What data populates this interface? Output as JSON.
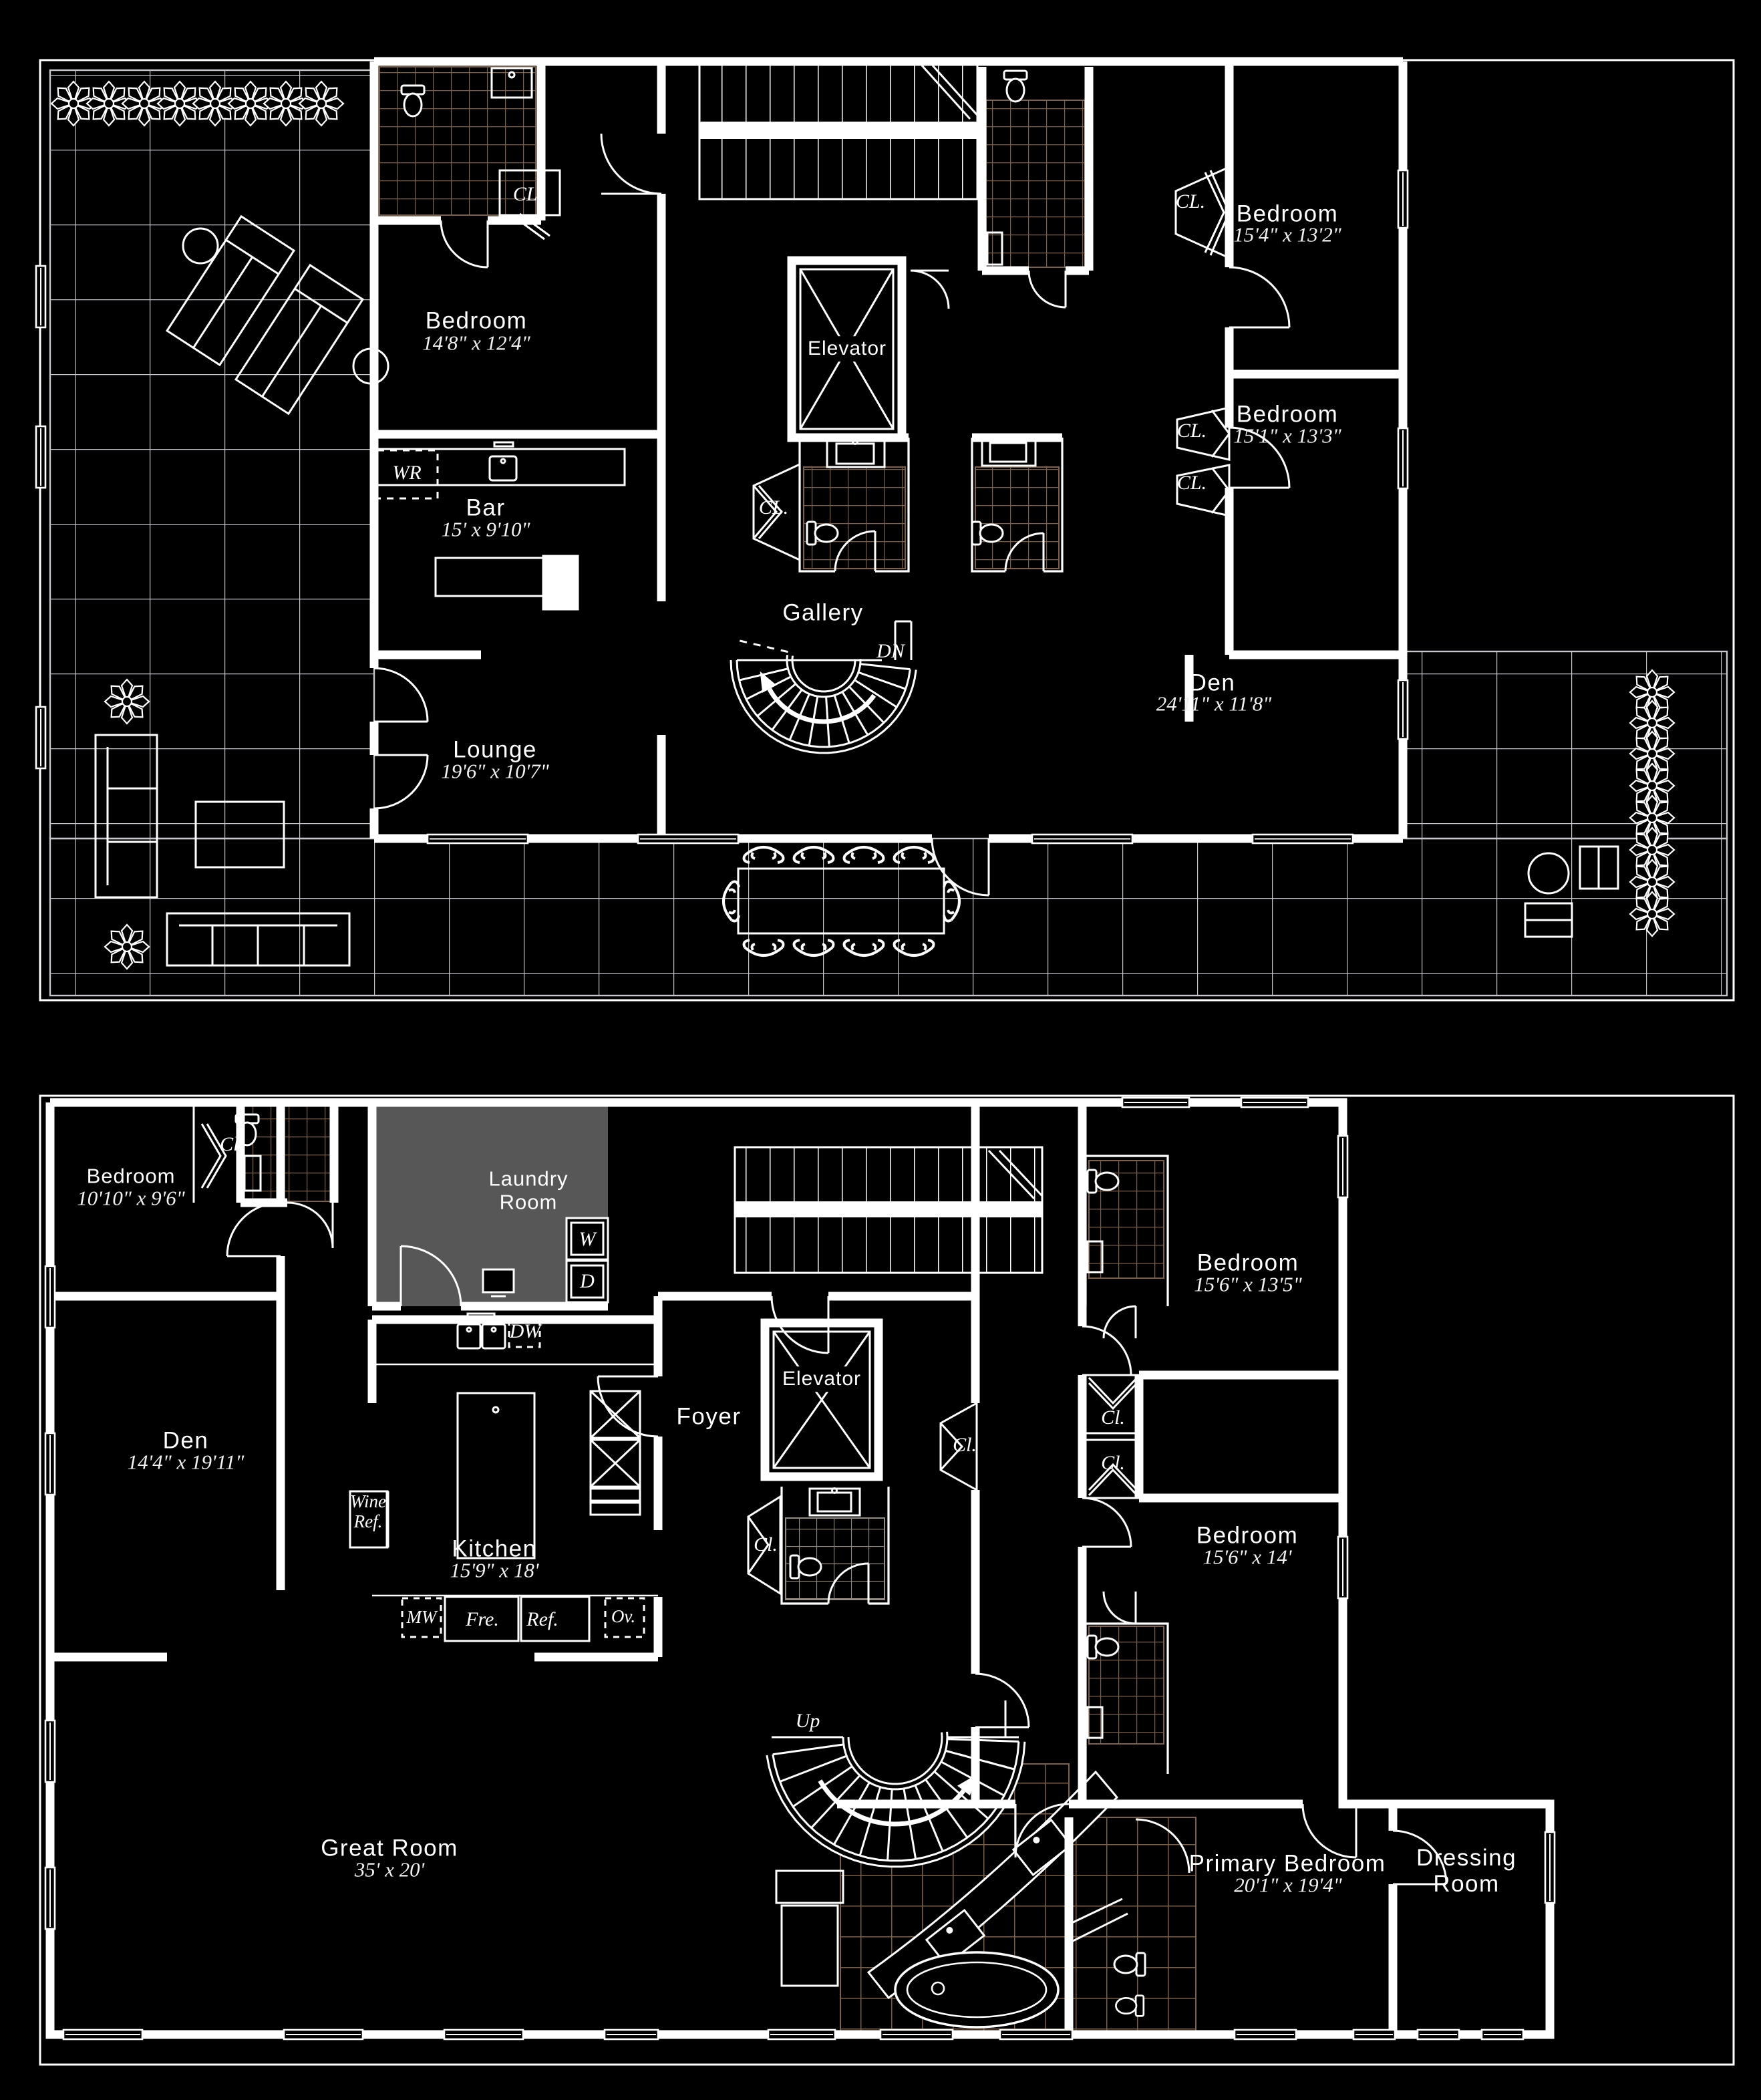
{
  "upper_floor": {
    "bedroom_nw": {
      "name": "Bedroom",
      "dims": "14'8\" x 12'4\""
    },
    "bar": {
      "name": "Bar",
      "dims": "15' x 9'10\""
    },
    "lounge": {
      "name": "Lounge",
      "dims": "19'6\" x 10'7\""
    },
    "gallery": {
      "name": "Gallery"
    },
    "elevator": {
      "name": "Elevator"
    },
    "den": {
      "name": "Den",
      "dims": "24'11\" x 11'8\""
    },
    "bedroom_ne": {
      "name": "Bedroom",
      "dims": "15'4\" x 13'2\""
    },
    "bedroom_e": {
      "name": "Bedroom",
      "dims": "15'1\" x 13'3\""
    },
    "closet_abbrev": "CL.",
    "water_room_abbrev": "WR",
    "stair_down_abbrev": "DN"
  },
  "lower_floor": {
    "bedroom_nw": {
      "name": "Bedroom",
      "dims": "10'10\" x 9'6\""
    },
    "laundry": {
      "name": "Laundry Room"
    },
    "den": {
      "name": "Den",
      "dims": "14'4\" x 19'11\""
    },
    "kitchen": {
      "name": "Kitchen",
      "dims": "15'9\" x 18'"
    },
    "foyer": {
      "name": "Foyer"
    },
    "elevator": {
      "name": "Elevator"
    },
    "great_room": {
      "name": "Great Room",
      "dims": "35' x 20'"
    },
    "bedroom_ne": {
      "name": "Bedroom",
      "dims": "15'6\" x 13'5\""
    },
    "bedroom_e": {
      "name": "Bedroom",
      "dims": "15'6\" x 14'"
    },
    "primary_bedroom": {
      "name": "Primary Bedroom",
      "dims": "20'1\" x 19'4\""
    },
    "dressing_room": {
      "name": "Dressing Room"
    },
    "closet_abbrev": "Cl.",
    "washer_abbrev": "W",
    "dryer_abbrev": "D",
    "dishwasher_abbrev": "DW",
    "microwave_abbrev": "MW",
    "freezer_abbrev": "Fre.",
    "fridge_abbrev": "Ref.",
    "oven_abbrev": "Ov.",
    "wine_fridge_abbrev": "Wine Ref.",
    "stair_up_abbrev": "Up"
  },
  "colors": {
    "background": "#000000",
    "line": "#ffffff",
    "bath_tile": "#7d6046",
    "terrace_grid": "#c8c5cc",
    "laundry_fill": "#575757"
  }
}
